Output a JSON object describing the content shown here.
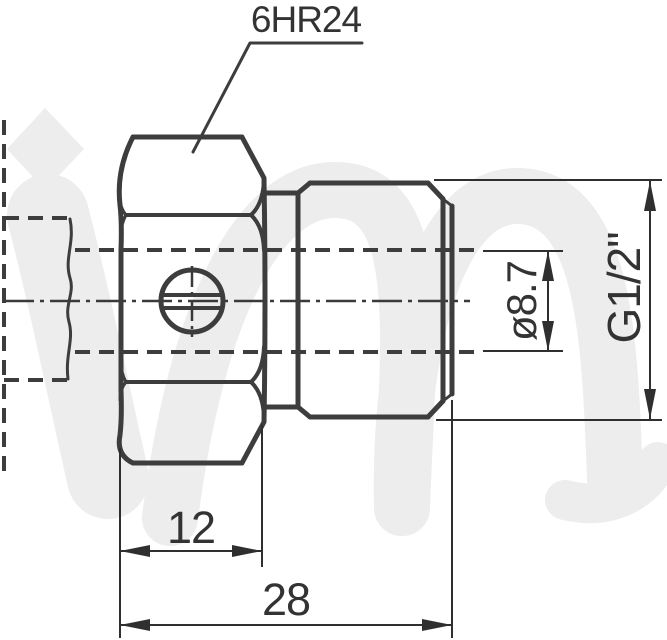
{
  "drawing": {
    "callout": "6HR24",
    "dimensions": {
      "hex_thickness": "12",
      "overall_length": "28",
      "bore_diameter": "ø8.7",
      "thread_size": "G1/2\""
    },
    "watermark": "im-logo",
    "colors": {
      "line": "#3d3d3d",
      "dimension_line": "#2f2f2f",
      "text": "#333333",
      "watermark": "#ededed",
      "background": "#ffffff"
    }
  }
}
